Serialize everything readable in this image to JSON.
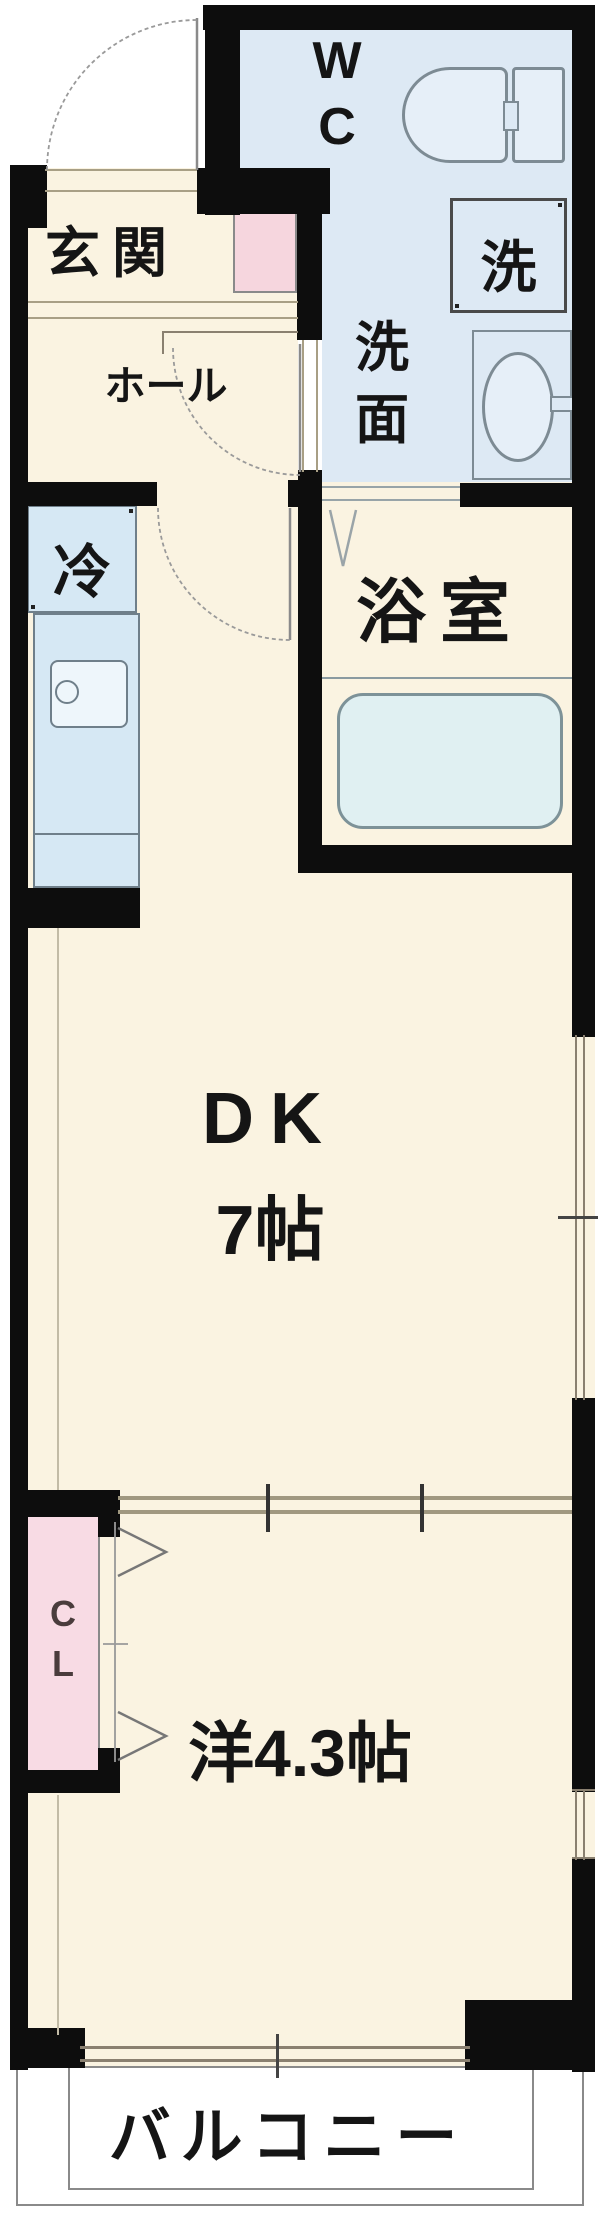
{
  "rooms": {
    "wc": {
      "label": "W\nC"
    },
    "washer": {
      "label": "洗"
    },
    "washroom": {
      "label": "洗\n面"
    },
    "bathroom": {
      "label": "浴室"
    },
    "genkan": {
      "label": "玄関"
    },
    "hall": {
      "label": "ホール"
    },
    "refrigerator": {
      "label": "冷"
    },
    "dk": {
      "name": "DK",
      "size": "7帖"
    },
    "closet": {
      "label": "C\nL"
    },
    "western": {
      "label": "洋4.3帖"
    },
    "balcony": {
      "label": "バルコニー"
    }
  },
  "fixtures": {
    "toilet": "toilet-icon",
    "washing_machine": "washing-machine-icon",
    "washbasin": "washbasin-icon",
    "bathtub": "bathtub-icon",
    "kitchen_sink": "kitchen-sink-icon",
    "refrigerator": "refrigerator-icon",
    "entrance_door": "door-arc-icon",
    "hall_doors": "door-arc-icon",
    "bathroom_door": "folding-door-icon",
    "closet_doors": "bifold-door-icon",
    "windows": "sliding-window-icon"
  },
  "palette": {
    "wall": "#0d0d0d",
    "floor_cream": "#faf3e1",
    "sanitary_blue": "#dde9f4",
    "bathroom_blue": "#d9ecef",
    "fixture_blue": "#d6e8f4",
    "shoebox_pink": "#f6d6de",
    "closet_pink": "#f8dbe4",
    "balcony_white": "#ffffff",
    "line_gray": "#8a8a8a",
    "sill_tan": "#a89f85"
  }
}
